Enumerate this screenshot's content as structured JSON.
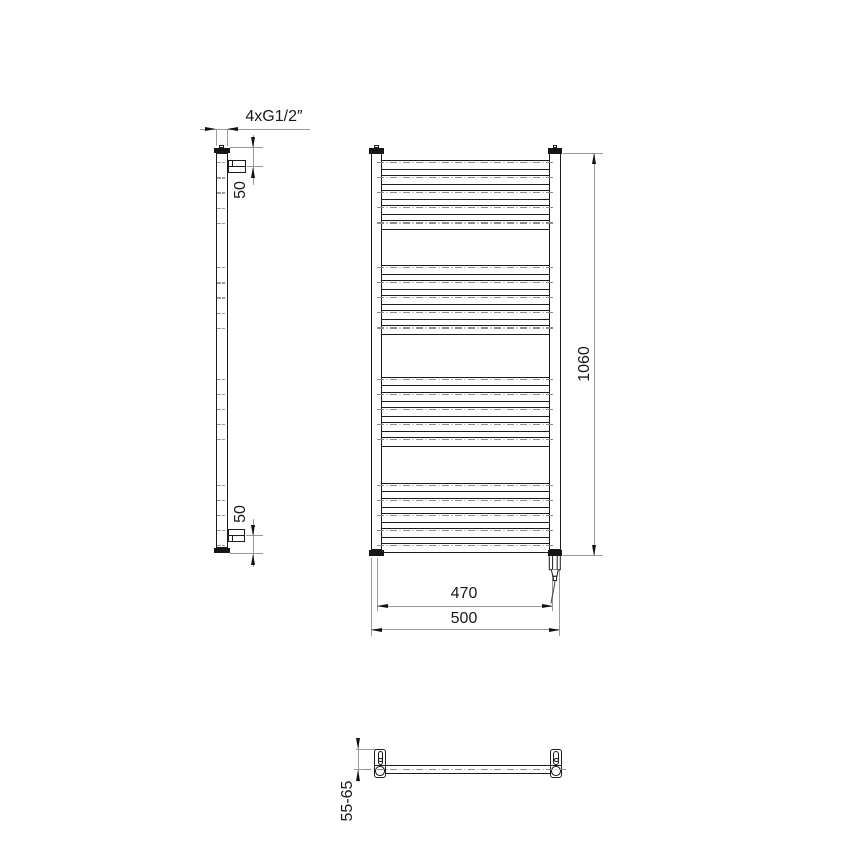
{
  "colors": {
    "outline": "#1c1c1c",
    "cap_fill": "#161616",
    "dim_line": "#9a9a9a",
    "center_line": "#8e8e8e",
    "text": "#1a1a1a",
    "background": "#ffffff"
  },
  "side_view": {
    "connection_label": "4xG1/2″",
    "top_offset_label": "50",
    "bottom_offset_label": "50"
  },
  "front_view": {
    "height_label": "1060",
    "mount_width_label": "470",
    "overall_width_label": "500",
    "rung_groups": 4,
    "rungs_per_group": 5
  },
  "top_view": {
    "wall_distance_label": "55-65"
  }
}
